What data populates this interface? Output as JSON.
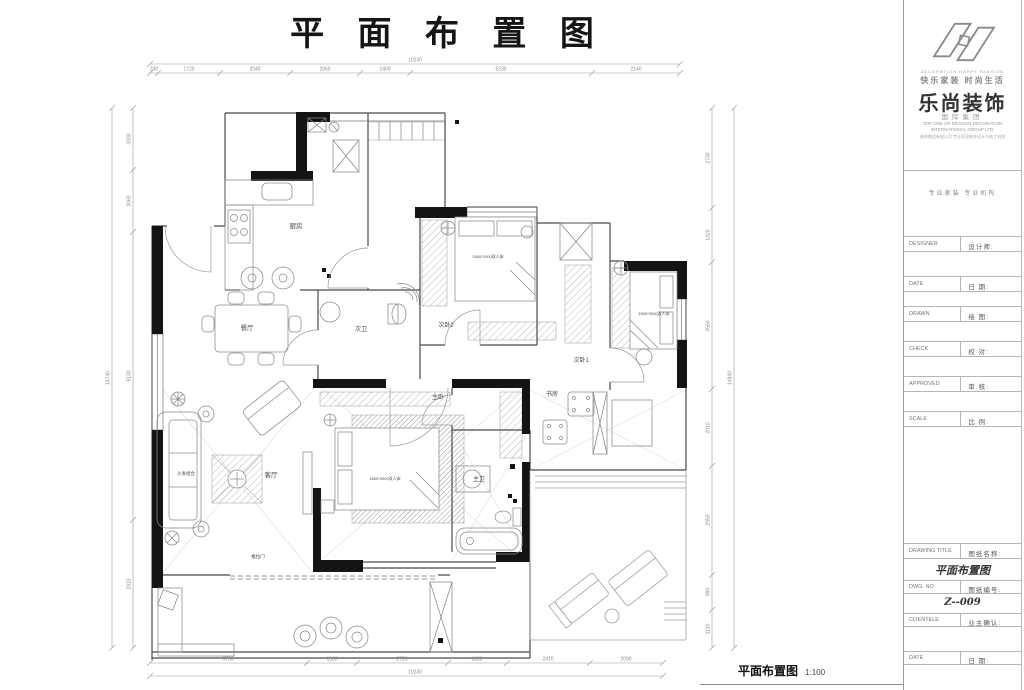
{
  "page": {
    "title": "平 面 布 置 图"
  },
  "footer": {
    "label": "平面布置图",
    "scale": "1:100"
  },
  "titleblock": {
    "slogan_en": "DECORATION HAPPY FASHION",
    "slogan_cn": "快乐家装 时尚生活",
    "brand": "乐尚装饰",
    "brand_sub": "国际集团",
    "group_en1": "TOP ONE OF DRAGON DECORATION",
    "group_en2": "INTERNATIONAL GROUP LTD.",
    "address": "装饰集团有限公司·专业家居装饰设计与施工机构",
    "tagline": "专业家装 专业机构",
    "fields": [
      {
        "en": "DESIGNER",
        "cn": "设计师:"
      },
      {
        "en": "DATE",
        "cn": "日 期:"
      },
      {
        "en": "DRAWN",
        "cn": "绘 图:"
      },
      {
        "en": "CHECK",
        "cn": "校 对:"
      },
      {
        "en": "APPROVED",
        "cn": "审 核:"
      },
      {
        "en": "SCALE",
        "cn": "比 例:"
      }
    ],
    "drawing_title_row": {
      "en": "DRAWING TITLE",
      "cn": "图纸名称:"
    },
    "drawing_title_value": "平面布置图",
    "dwg_no_row": {
      "en": "DWG. NO",
      "cn": "图纸编号:"
    },
    "dwg_no_value": "Z--009",
    "client_row": {
      "en": "CLIENTELE",
      "cn": "业主确认:"
    },
    "date_row": {
      "en": "DATE",
      "cn": "日 期:"
    }
  },
  "plan": {
    "labels": [
      {
        "t": "厨房",
        "x": 296,
        "y": 228,
        "s": 6.5
      },
      {
        "t": "餐厅",
        "x": 247,
        "y": 330,
        "s": 6.5
      },
      {
        "t": "次卫",
        "x": 361,
        "y": 331,
        "s": 6
      },
      {
        "t": "次卧2",
        "x": 446,
        "y": 327,
        "s": 6
      },
      {
        "t": "次卧1",
        "x": 581,
        "y": 362,
        "s": 6
      },
      {
        "t": "主卧",
        "x": 438,
        "y": 399,
        "s": 6
      },
      {
        "t": "书房",
        "x": 552,
        "y": 396,
        "s": 6
      },
      {
        "t": "客厅",
        "x": 271,
        "y": 477,
        "s": 6.5
      },
      {
        "t": "主卫",
        "x": 479,
        "y": 481,
        "s": 6
      },
      {
        "t": "沙发组合",
        "x": 186,
        "y": 475,
        "s": 4.5
      },
      {
        "t": "推拉门",
        "x": 258,
        "y": 558,
        "s": 4.5
      },
      {
        "t": "1500*2000双人床",
        "x": 488,
        "y": 258,
        "s": 4
      },
      {
        "t": "1500*2000双人床",
        "x": 654,
        "y": 315,
        "s": 4
      },
      {
        "t": "1800*2000双人床",
        "x": 385,
        "y": 480,
        "s": 4
      }
    ],
    "dims": {
      "top": {
        "dir": "h",
        "line": 73,
        "from": 150,
        "to": 680,
        "ticks": [
          150,
          158,
          220,
          290,
          360,
          410,
          592,
          680
        ],
        "labels": [
          {
            "v": "240",
            "p": 154
          },
          {
            "v": "1720",
            "p": 189
          },
          {
            "v": "2040",
            "p": 255
          },
          {
            "v": "2060",
            "p": 325
          },
          {
            "v": "1400",
            "p": 385
          },
          {
            "v": "5230",
            "p": 501
          },
          {
            "v": "2140",
            "p": 636
          }
        ],
        "overall": {
          "v": "10230",
          "line": 64,
          "p": 415
        }
      },
      "bottom": {
        "dir": "h",
        "line": 663,
        "from": 150,
        "to": 663,
        "ticks": [
          150,
          307,
          357,
          448,
          507,
          590,
          663
        ],
        "labels": [
          {
            "v": "6730",
            "p": 228
          },
          {
            "v": "1300",
            "p": 332
          },
          {
            "v": "2720",
            "p": 402
          },
          {
            "v": "1800",
            "p": 477
          },
          {
            "v": "2410",
            "p": 548
          },
          {
            "v": "2090",
            "p": 626
          }
        ],
        "overall": {
          "v": "10230",
          "line": 676,
          "p": 415
        }
      },
      "left": {
        "dir": "v",
        "line": 133,
        "from": 108,
        "to": 648,
        "ticks": [
          108,
          170,
          232,
          520,
          648
        ],
        "labels": [
          {
            "v": "3030",
            "p": 139
          },
          {
            "v": "3060",
            "p": 201
          },
          {
            "v": "9130",
            "p": 376
          },
          {
            "v": "1910",
            "p": 584
          }
        ],
        "overall": {
          "v": "14740",
          "line": 112,
          "p": 378
        }
      },
      "right": {
        "dir": "v",
        "line": 712,
        "from": 108,
        "to": 648,
        "ticks": [
          108,
          208,
          262,
          389,
          466,
          575,
          610,
          648
        ],
        "labels": [
          {
            "v": "2730",
            "p": 158
          },
          {
            "v": "1320",
            "p": 235
          },
          {
            "v": "3560",
            "p": 326
          },
          {
            "v": "2010",
            "p": 428
          },
          {
            "v": "2950",
            "p": 520
          },
          {
            "v": "990",
            "p": 592
          },
          {
            "v": "1130",
            "p": 629
          }
        ],
        "overall": {
          "v": "14940",
          "line": 734,
          "p": 378
        }
      }
    }
  }
}
